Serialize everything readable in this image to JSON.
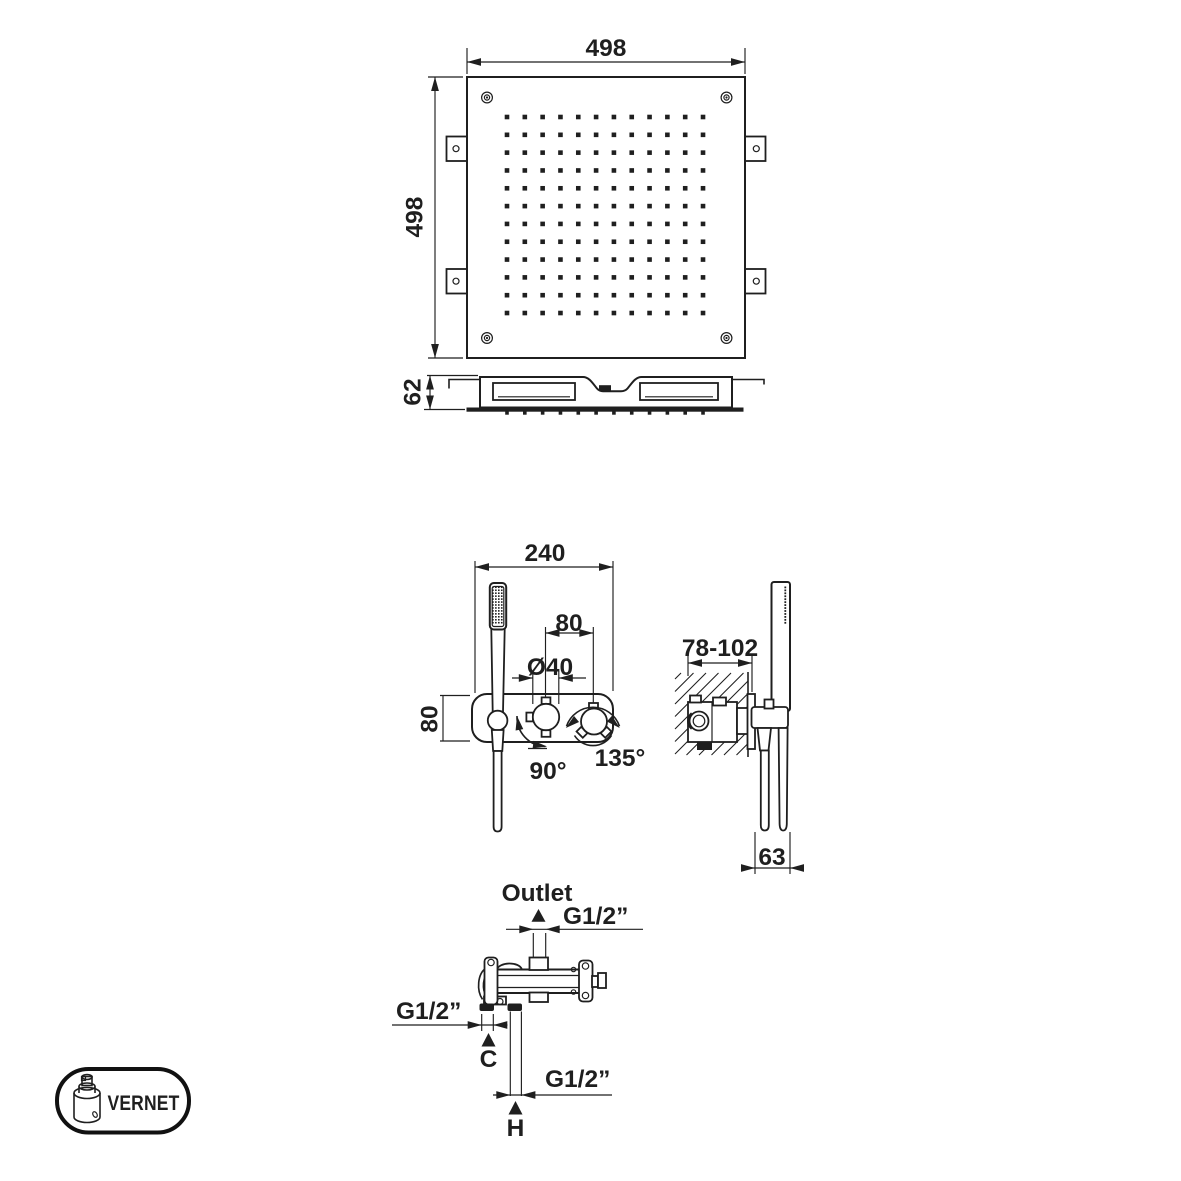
{
  "colors": {
    "line": "#1f1f1f",
    "background": "#ffffff"
  },
  "views": {
    "head_top": {
      "width_dim": "498",
      "height_dim": "498",
      "nozzle_grid": {
        "cols": 12,
        "rows": 12
      }
    },
    "head_profile": {
      "height_dim": "62"
    },
    "mixer_front": {
      "width_dim": "240",
      "knob_spacing_dim": "80",
      "knob_diameter_dim": "Ø40",
      "plate_height_dim": "80",
      "diverter_rotation": "90°",
      "mixer_rotation": "135°",
      "spray_grid": {
        "cols": 4,
        "rows": 13
      }
    },
    "mixer_side": {
      "recess_depth_dim": "78-102",
      "projection_dim": "63",
      "side_spray_rows": 13
    },
    "connections": {
      "outlet_label": "Outlet",
      "outlet_thread": "G1/2”",
      "cold_thread": "G1/2”",
      "hot_thread": "G1/2”",
      "cold_marker": "C",
      "hot_marker": "H"
    },
    "logo": {
      "brand": "VERNET"
    }
  }
}
